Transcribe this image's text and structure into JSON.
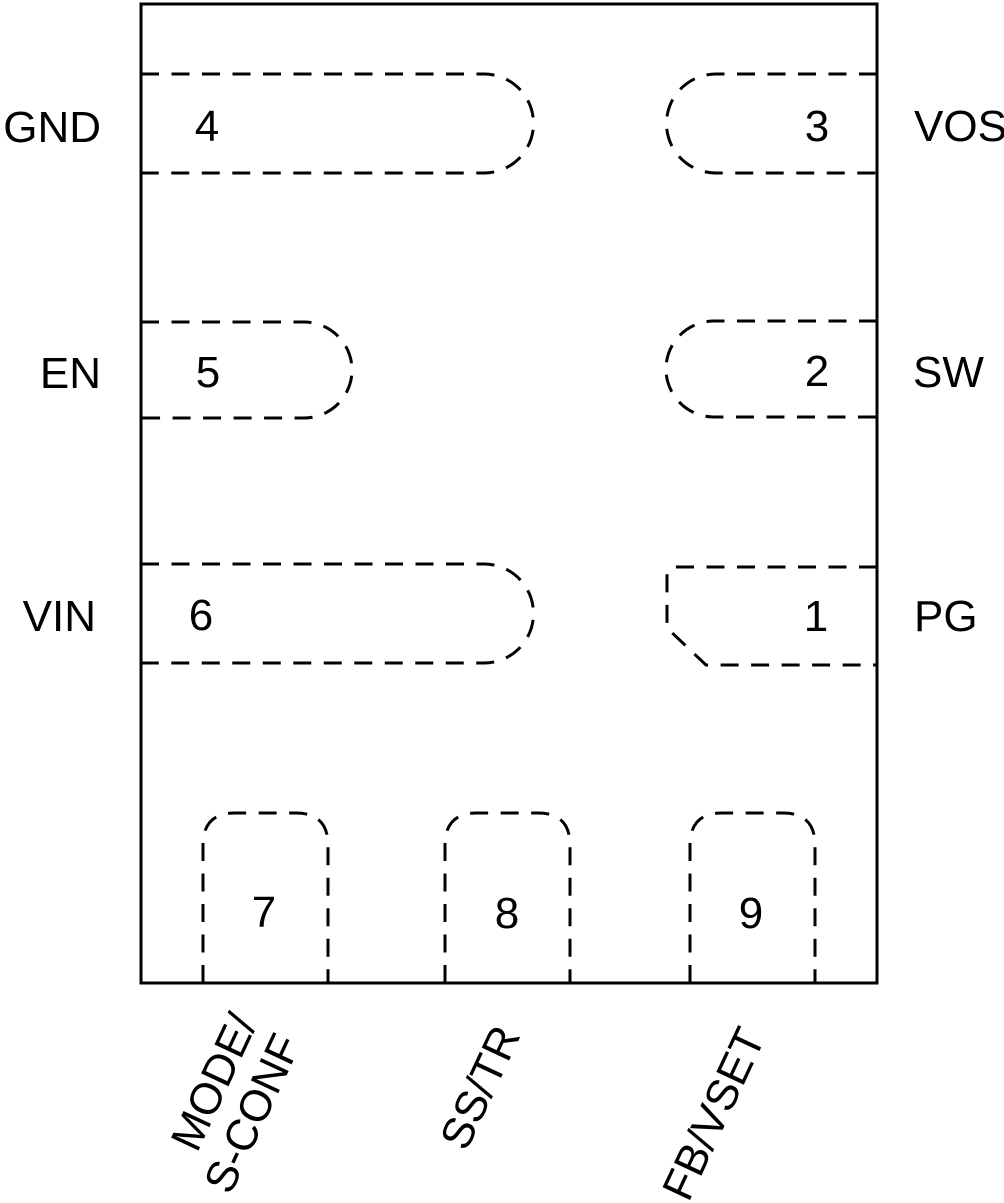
{
  "diagram": {
    "type": "ic-package-pinout",
    "colors": {
      "line": "#000000",
      "background": "#ffffff"
    },
    "pins": {
      "left": [
        {
          "number": "4",
          "label": "GND"
        },
        {
          "number": "5",
          "label": "EN"
        },
        {
          "number": "6",
          "label": "VIN"
        }
      ],
      "right": [
        {
          "number": "3",
          "label": "VOS"
        },
        {
          "number": "2",
          "label": "SW"
        },
        {
          "number": "1",
          "label": "PG"
        }
      ],
      "bottom": [
        {
          "number": "7",
          "label_lines": [
            "MODE/",
            "S-CONF"
          ]
        },
        {
          "number": "8",
          "label": "SS/TR"
        },
        {
          "number": "9",
          "label": "FB/VSET"
        }
      ]
    }
  }
}
